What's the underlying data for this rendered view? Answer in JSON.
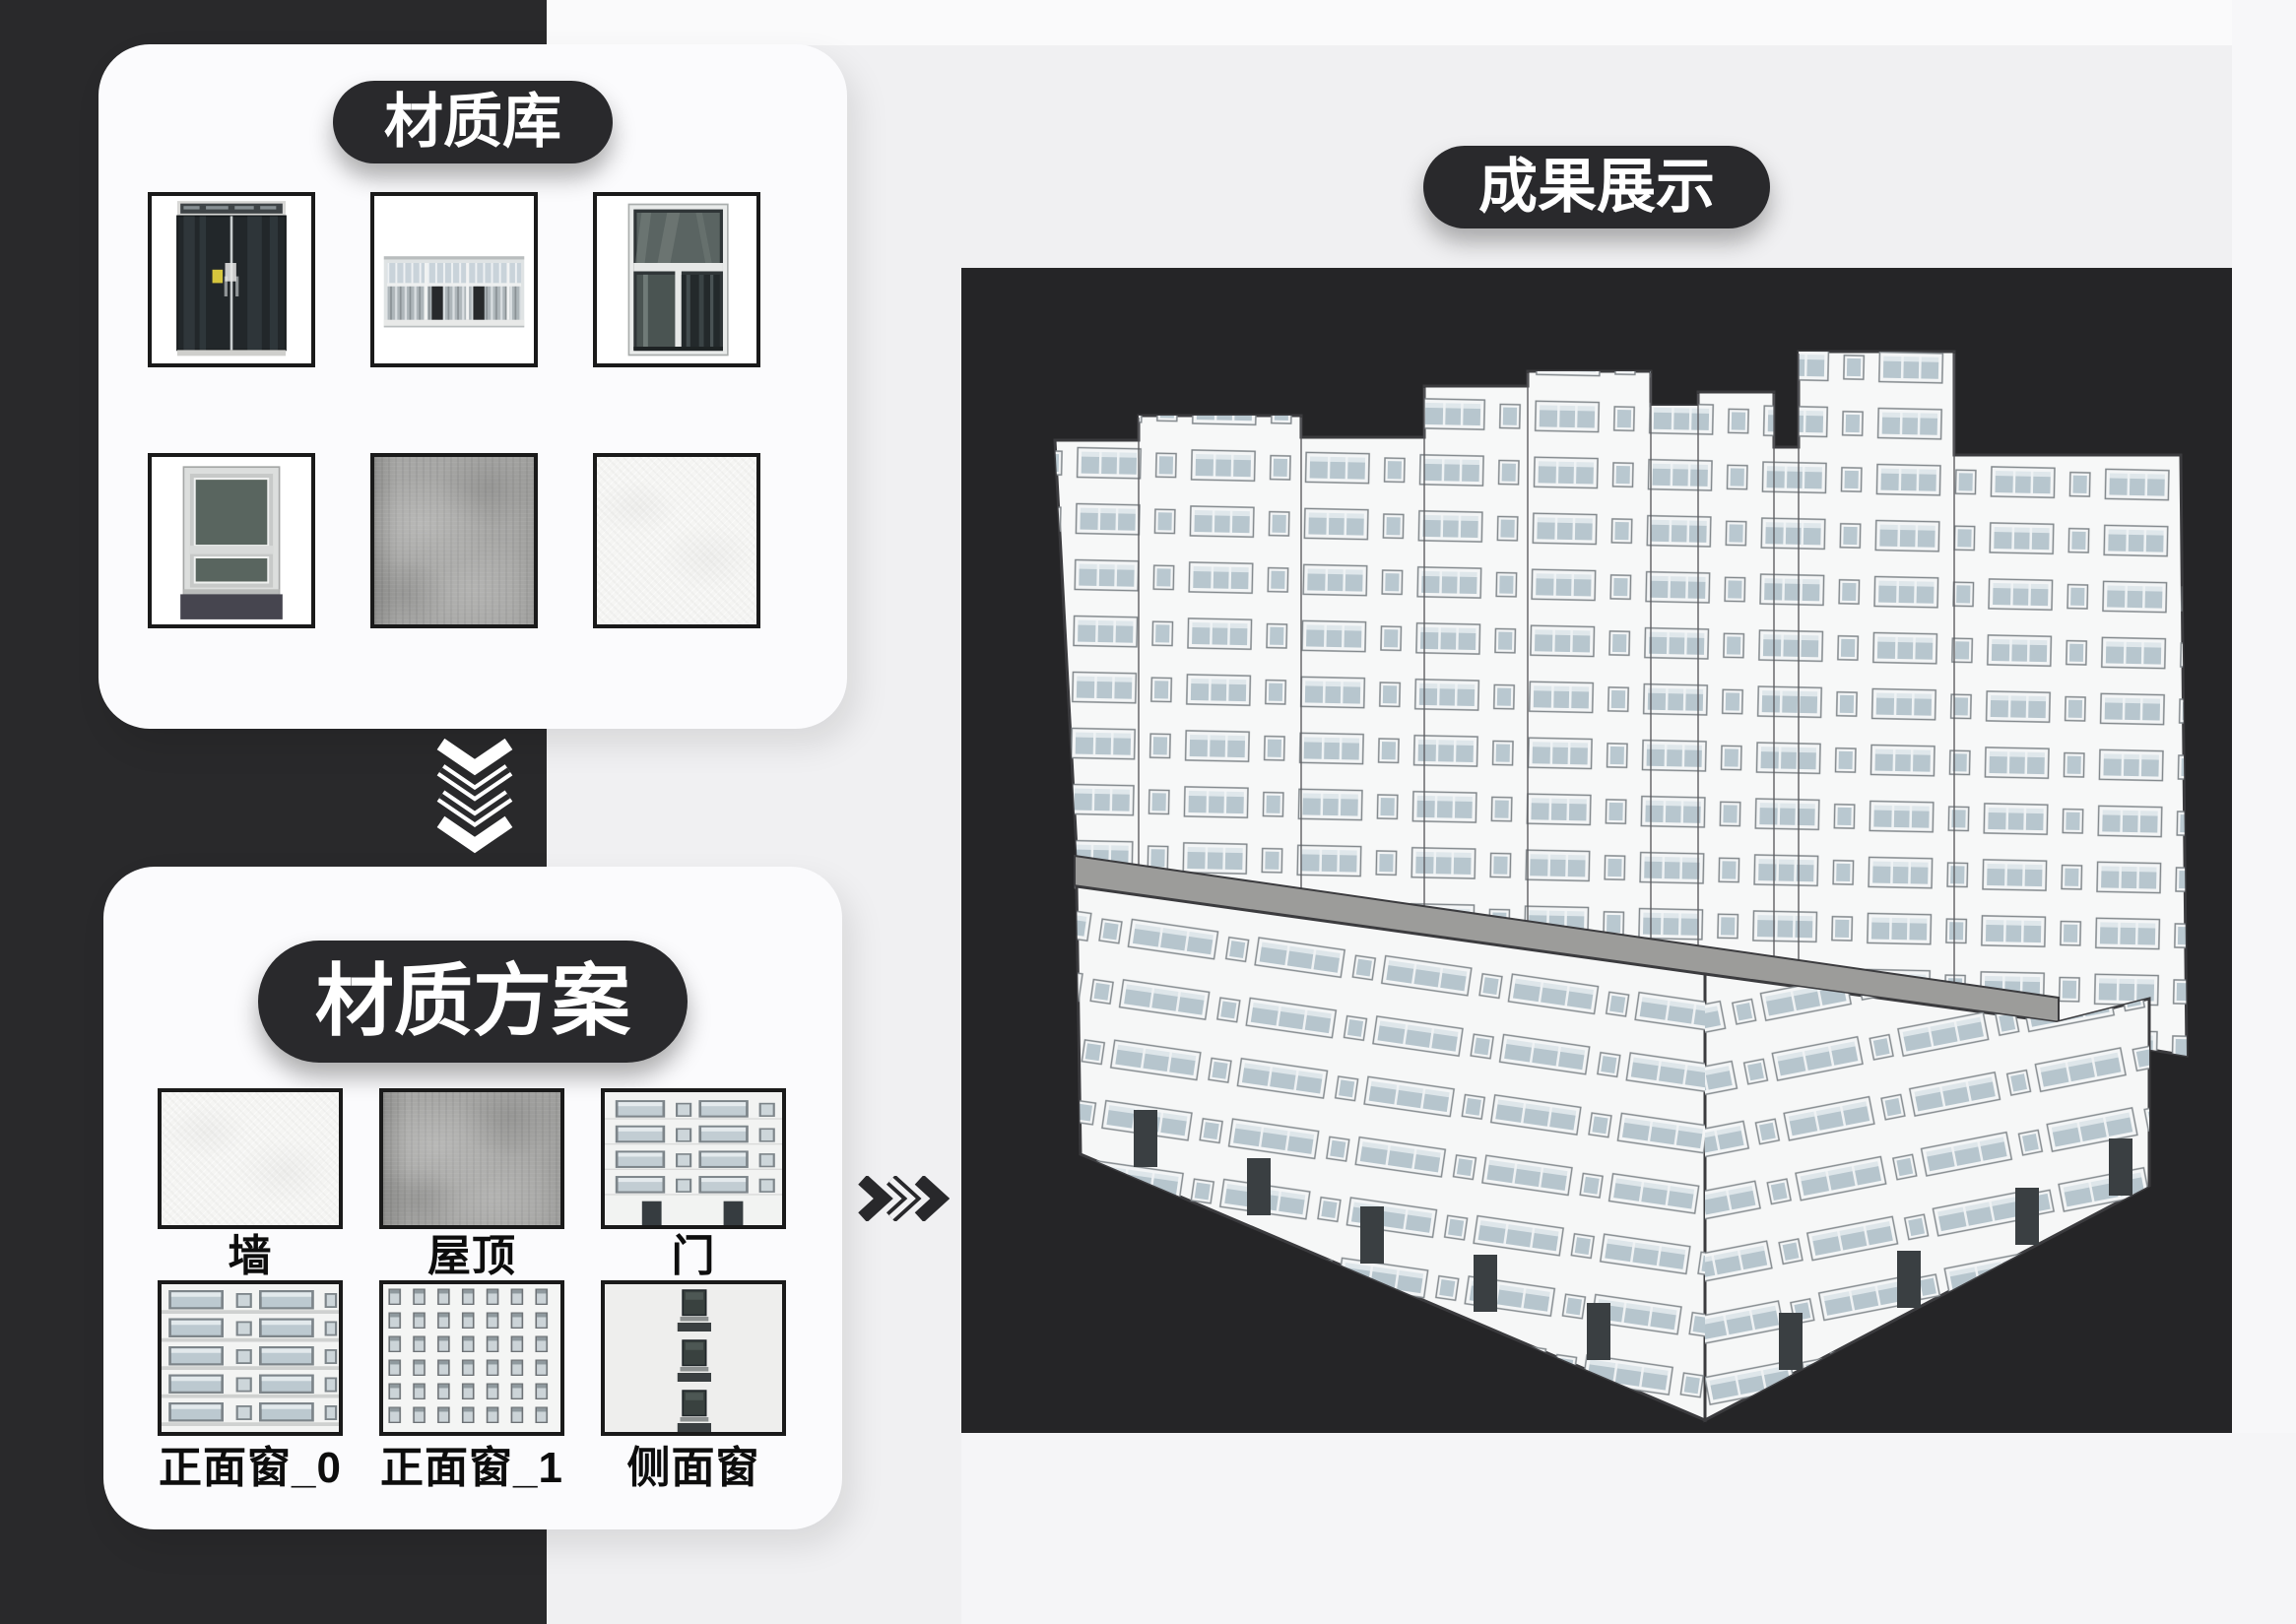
{
  "library_card": {
    "badge": "材质库",
    "thumbnails": [
      {
        "name": "glass-door-photo"
      },
      {
        "name": "band-window-photo"
      },
      {
        "name": "tall-window-photo"
      },
      {
        "name": "sill-window-photo"
      },
      {
        "name": "concrete-texture"
      },
      {
        "name": "plaster-texture"
      }
    ]
  },
  "scheme_card": {
    "badge": "材质方案",
    "items": [
      {
        "label": "墙",
        "texture": "plaster-texture"
      },
      {
        "label": "屋顶",
        "texture": "concrete-texture"
      },
      {
        "label": "门",
        "texture": "door-facade-texture"
      },
      {
        "label": "正面窗_0",
        "texture": "front-window-0-facade-texture"
      },
      {
        "label": "正面窗_1",
        "texture": "front-window-1-facade-texture"
      },
      {
        "label": "侧面窗",
        "texture": "side-window-facade-texture"
      }
    ]
  },
  "result_panel": {
    "badge": "成果展示",
    "content": "3d-building-render"
  },
  "icons": {
    "down_arrow": "triple-chevron-down",
    "right_arrow": "triple-chevron-right"
  },
  "colors": {
    "accent_dark": "#29292b",
    "canvas_bg": "#f0f0f2",
    "panel_bg": "#252527",
    "card_bg": "#fbfbfd",
    "terrace_gray": "#9c9c9a",
    "window_glass": "#b7c6ce",
    "building_wall": "#f7f8f8"
  }
}
